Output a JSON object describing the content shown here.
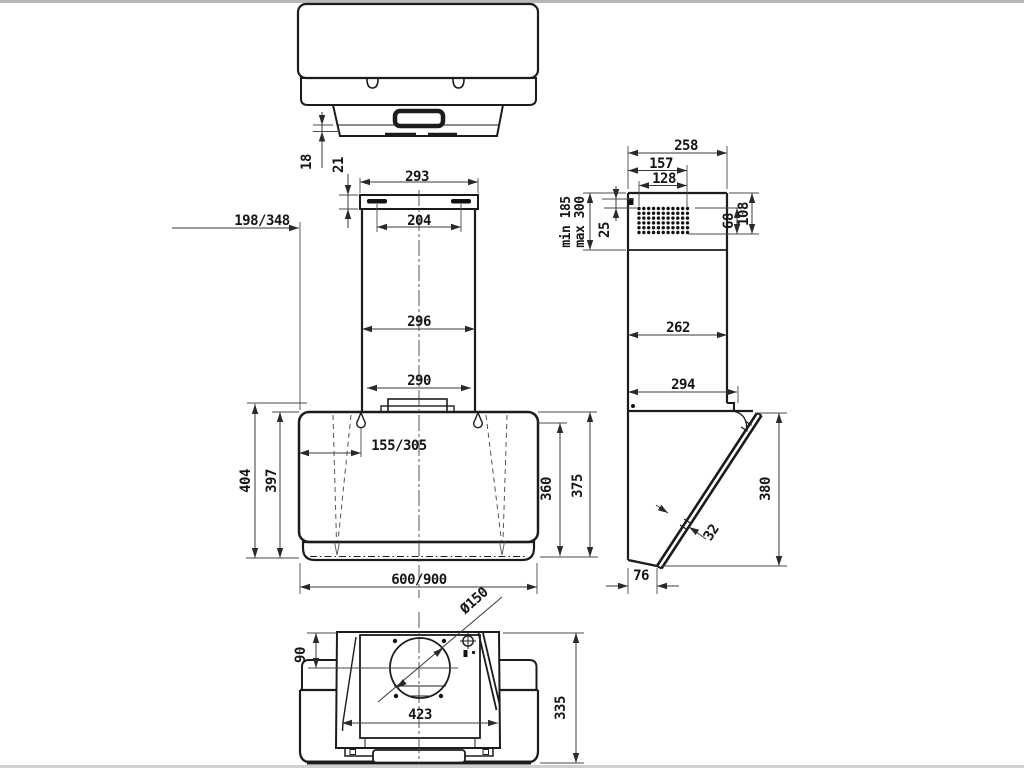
{
  "colors": {
    "background": "#ffffff",
    "outline": "#1c1c1c",
    "dimension_line": "#3a3a3a",
    "text": "#161616",
    "edge_strip": "#b8b8b8"
  },
  "dims": {
    "d18": "18",
    "d21": "21",
    "d198_348": "198/348",
    "d293": "293",
    "d204": "204",
    "d296": "296",
    "d290": "290",
    "d155_305": "155/305",
    "d404": "404",
    "d397": "397",
    "d360": "360",
    "d375": "375",
    "d600_900": "600/900",
    "d258": "258",
    "d157": "157",
    "d128": "128",
    "min185": "min 185",
    "max300": "max 300",
    "d25": "25",
    "d68": "68",
    "d108": "108",
    "d262": "262",
    "d294": "294",
    "d380": "380",
    "d32": "32",
    "d76": "76",
    "phi150": "Ø150",
    "d90": "90",
    "d423": "423",
    "d335": "335"
  }
}
